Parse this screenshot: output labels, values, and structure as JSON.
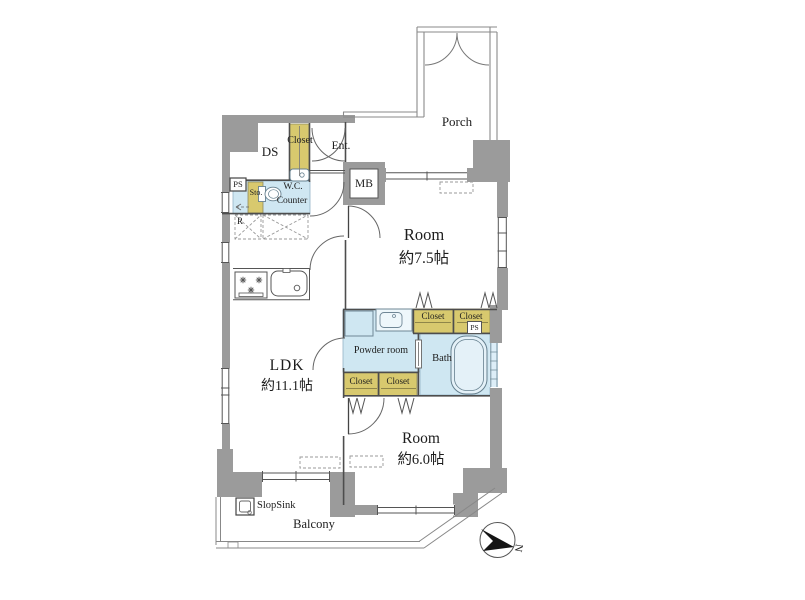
{
  "plan": {
    "title": "apartment-floor-plan",
    "rooms": {
      "ldk": {
        "name": "LDK",
        "size": "約11.1帖"
      },
      "room1": {
        "name": "Room",
        "size": "約7.5帖"
      },
      "room2": {
        "name": "Room",
        "size": "約6.0帖"
      },
      "powder_room": "Powder room",
      "bath": "Bath",
      "wc": {
        "line1": "W.C.",
        "line2": "Counter"
      },
      "ds": "DS",
      "entrance": "Ent."
    },
    "areas": {
      "porch": "Porch",
      "balcony": "Balcony"
    },
    "closets": [
      "Closet",
      "Closet",
      "Closet",
      "Closet",
      "Closet"
    ],
    "fixtures": {
      "mb": "MB",
      "ps_upper": "PS",
      "ps_closet": "PS",
      "storage": "Sto.",
      "refrigerator": "R",
      "slop_sink": "SlopSink"
    },
    "compass": {
      "north": "N"
    },
    "colors": {
      "wall": "#9b9b9b",
      "closet_fill": "#d8c96e",
      "water_fill": "#cfe7f2",
      "line": "#4d4d4d"
    }
  }
}
